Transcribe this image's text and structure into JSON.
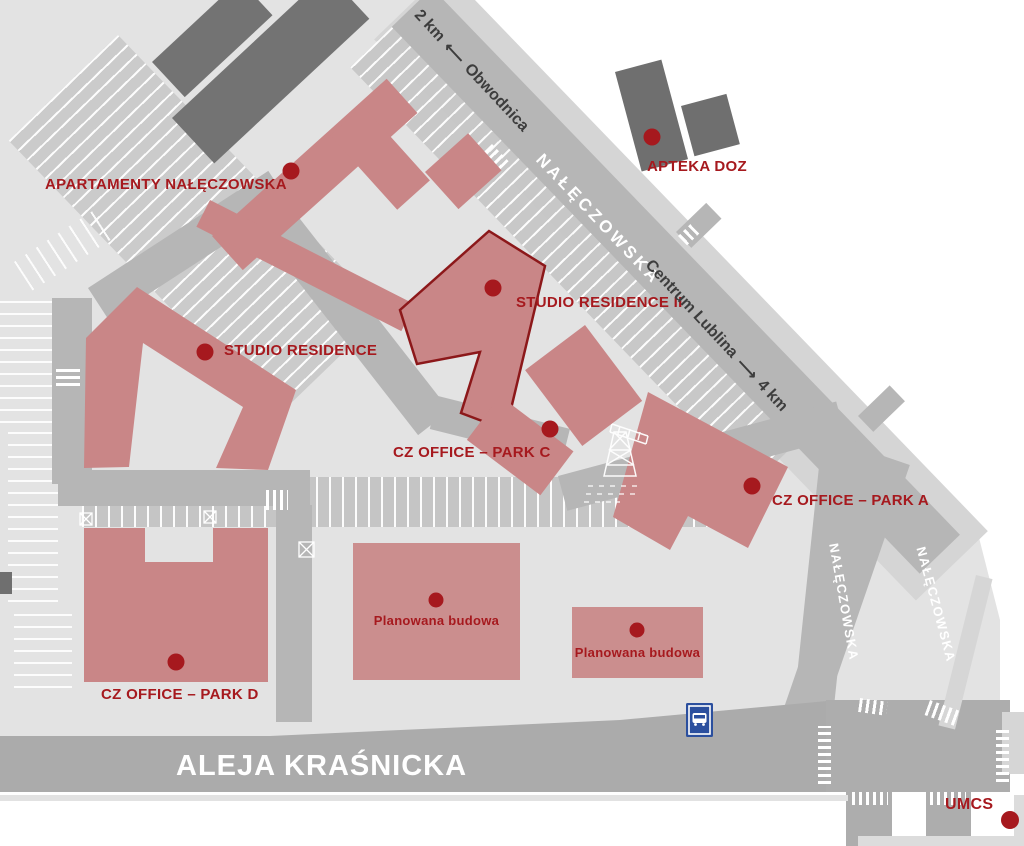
{
  "map_title": "Site map of CZ Office Park area, Lublin",
  "colors": {
    "campus": "#e3e3e3",
    "road": "#b6b6b6",
    "aleja_road": "#ababab",
    "parking": "#c8c8c8",
    "building": "#c98687",
    "building_planned": "#cb8e8e",
    "building_dark": "#737373",
    "marker": "#a6191e",
    "label": "#a6191e",
    "outline_highlight": "#8c181a",
    "bus_sign": "#2b4f9e",
    "street_text": "#ffffff",
    "direction_text": "#3d3d3d"
  },
  "pois": {
    "apartamenty": {
      "label": "APARTAMENTY NAŁĘCZOWSKA"
    },
    "apteka_doz": {
      "label": "APTEKA DOZ"
    },
    "studio_residence": {
      "label": "STUDIO RESIDENCE"
    },
    "studio_residence_2": {
      "label": "STUDIO RESIDENCE II"
    },
    "cz_office_park_c": {
      "label": "CZ OFFICE – PARK C"
    },
    "cz_office_park_a": {
      "label": "CZ OFFICE – PARK A"
    },
    "cz_office_park_d": {
      "label": "CZ OFFICE – PARK D"
    },
    "planowana_budowa_1": {
      "label": "Planowana budowa"
    },
    "planowana_budowa_2": {
      "label": "Planowana budowa"
    },
    "umcs": {
      "label": "UMCS"
    }
  },
  "streets": {
    "naleczowska_main": "NAŁĘCZOWSKA",
    "naleczowska_branch_left": "NAŁĘCZOWSKA",
    "naleczowska_branch_right": "NAŁĘCZOWSKA",
    "aleja_krasnicka": "ALEJA KRAŚNICKA"
  },
  "directions": {
    "obwodnica_distance": "2 km",
    "obwodnica_arrow": "⟵",
    "obwodnica_name": "Obwodnica",
    "centrum_name": "Centrum Lublina",
    "centrum_arrow": "⟶",
    "centrum_distance": "4 km"
  },
  "icons": {
    "bus_stop": "bus-stop-sign",
    "crane": "construction-crane"
  }
}
